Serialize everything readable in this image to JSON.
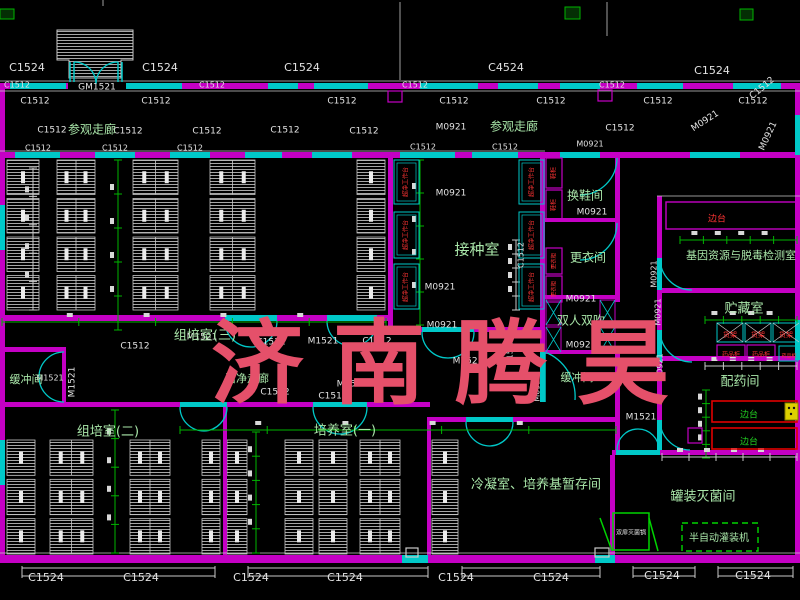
{
  "watermark": {
    "text": "济南腾昊",
    "color": "#e5506a"
  },
  "colors": {
    "wall": "#c400c4",
    "window": "#00c8c8",
    "dim_line": "#00b400",
    "white_line": "#c9c9c9",
    "code_text": "#e2e2e2",
    "room_text": "#a9e6a9",
    "equip_red": "#ff3434",
    "equip_green": "#22d022",
    "machine_green": "#00d400",
    "yellow": "#ddd000",
    "background": "#000000"
  },
  "labels": {
    "window_door_codes": [
      {
        "t": "C1524",
        "x": 27,
        "y": 68,
        "s": 11
      },
      {
        "t": "C1524",
        "x": 160,
        "y": 68,
        "s": 11
      },
      {
        "t": "C1524",
        "x": 302,
        "y": 68,
        "s": 11
      },
      {
        "t": "C4524",
        "x": 506,
        "y": 68,
        "s": 11
      },
      {
        "t": "C1524",
        "x": 712,
        "y": 71,
        "s": 11
      },
      {
        "t": "C1512",
        "x": 762,
        "y": 88,
        "s": 9,
        "r": -40
      },
      {
        "t": "GM1521",
        "x": 97,
        "y": 87,
        "s": 9
      },
      {
        "t": "C1512",
        "x": 17,
        "y": 85,
        "s": 8
      },
      {
        "t": "C1512",
        "x": 212,
        "y": 85,
        "s": 8
      },
      {
        "t": "C1512",
        "x": 415,
        "y": 85,
        "s": 8
      },
      {
        "t": "C1512",
        "x": 612,
        "y": 85,
        "s": 8
      },
      {
        "t": "C1512",
        "x": 35,
        "y": 101,
        "s": 9
      },
      {
        "t": "C1512",
        "x": 156,
        "y": 101,
        "s": 9
      },
      {
        "t": "C1512",
        "x": 342,
        "y": 101,
        "s": 9
      },
      {
        "t": "C1512",
        "x": 454,
        "y": 101,
        "s": 9
      },
      {
        "t": "C1512",
        "x": 551,
        "y": 101,
        "s": 9
      },
      {
        "t": "C1512",
        "x": 658,
        "y": 101,
        "s": 9
      },
      {
        "t": "C1512",
        "x": 753,
        "y": 101,
        "s": 9
      },
      {
        "t": "C1512",
        "x": 52,
        "y": 130,
        "s": 9
      },
      {
        "t": "C1512",
        "x": 128,
        "y": 131,
        "s": 9
      },
      {
        "t": "C1512",
        "x": 207,
        "y": 131,
        "s": 9
      },
      {
        "t": "C1512",
        "x": 285,
        "y": 130,
        "s": 9
      },
      {
        "t": "C1512",
        "x": 364,
        "y": 131,
        "s": 9
      },
      {
        "t": "M0921",
        "x": 451,
        "y": 127,
        "s": 9
      },
      {
        "t": "C1512",
        "x": 620,
        "y": 128,
        "s": 9
      },
      {
        "t": "M0921",
        "x": 705,
        "y": 121,
        "s": 9,
        "r": -33
      },
      {
        "t": "M0921",
        "x": 768,
        "y": 136,
        "s": 9,
        "r": -65
      },
      {
        "t": "C1512",
        "x": 38,
        "y": 148,
        "s": 8
      },
      {
        "t": "C1512",
        "x": 115,
        "y": 148,
        "s": 8
      },
      {
        "t": "C1512",
        "x": 190,
        "y": 148,
        "s": 8
      },
      {
        "t": "C1512",
        "x": 423,
        "y": 147,
        "s": 8
      },
      {
        "t": "C1512",
        "x": 505,
        "y": 147,
        "s": 8
      },
      {
        "t": "M0921",
        "x": 590,
        "y": 144,
        "s": 8
      },
      {
        "t": "M0921",
        "x": 451,
        "y": 193,
        "s": 9
      },
      {
        "t": "M0921",
        "x": 440,
        "y": 287,
        "s": 9
      },
      {
        "t": "M0921",
        "x": 442,
        "y": 325,
        "s": 9
      },
      {
        "t": "M0921",
        "x": 592,
        "y": 212,
        "s": 9
      },
      {
        "t": "M0921",
        "x": 581,
        "y": 299,
        "s": 9
      },
      {
        "t": "M0921",
        "x": 581,
        "y": 345,
        "s": 9
      },
      {
        "t": "C1512",
        "x": 521,
        "y": 255,
        "s": 8,
        "r": -90
      },
      {
        "t": "M1521",
        "x": 202,
        "y": 337,
        "s": 9
      },
      {
        "t": "C1512",
        "x": 271,
        "y": 342,
        "s": 9
      },
      {
        "t": "M1521",
        "x": 323,
        "y": 341,
        "s": 9
      },
      {
        "t": "C1512",
        "x": 377,
        "y": 341,
        "s": 9
      },
      {
        "t": "C1512",
        "x": 135,
        "y": 346,
        "s": 9
      },
      {
        "t": "M1521",
        "x": 72,
        "y": 382,
        "s": 9,
        "r": -90
      },
      {
        "t": "M1521",
        "x": 50,
        "y": 378,
        "s": 8
      },
      {
        "t": "M1521",
        "x": 352,
        "y": 384,
        "s": 9
      },
      {
        "t": "C1512",
        "x": 275,
        "y": 392,
        "s": 9
      },
      {
        "t": "C1512",
        "x": 333,
        "y": 396,
        "s": 9
      },
      {
        "t": "M1521",
        "x": 468,
        "y": 361,
        "s": 9
      },
      {
        "t": "C1512",
        "x": 510,
        "y": 352,
        "s": 8,
        "r": -90
      },
      {
        "t": "M0921",
        "x": 537,
        "y": 388,
        "s": 8,
        "r": -90
      },
      {
        "t": "M0921",
        "x": 660,
        "y": 367,
        "s": 8,
        "r": -90
      },
      {
        "t": "M1521",
        "x": 641,
        "y": 417,
        "s": 9
      },
      {
        "t": "M0921",
        "x": 654,
        "y": 274,
        "s": 8,
        "r": -90
      },
      {
        "t": "M0921",
        "x": 658,
        "y": 312,
        "s": 8,
        "r": -90
      },
      {
        "t": "C1524",
        "x": 46,
        "y": 578,
        "s": 11
      },
      {
        "t": "C1524",
        "x": 141,
        "y": 578,
        "s": 11
      },
      {
        "t": "C1524",
        "x": 251,
        "y": 578,
        "s": 11
      },
      {
        "t": "C1524",
        "x": 345,
        "y": 578,
        "s": 11
      },
      {
        "t": "C1524",
        "x": 456,
        "y": 578,
        "s": 11
      },
      {
        "t": "C1524",
        "x": 551,
        "y": 578,
        "s": 11
      },
      {
        "t": "C1524",
        "x": 662,
        "y": 576,
        "s": 11
      },
      {
        "t": "C1524",
        "x": 753,
        "y": 576,
        "s": 11
      }
    ],
    "room_names": [
      {
        "t": "参观走廊",
        "x": 92,
        "y": 130,
        "s": 12
      },
      {
        "t": "参观走廊",
        "x": 514,
        "y": 127,
        "s": 12
      },
      {
        "t": "组培室(三)",
        "x": 205,
        "y": 336,
        "s": 13
      },
      {
        "t": "接种室",
        "x": 477,
        "y": 250,
        "s": 15
      },
      {
        "t": "换鞋间",
        "x": 585,
        "y": 196,
        "s": 12
      },
      {
        "t": "更衣间",
        "x": 588,
        "y": 258,
        "s": 12
      },
      {
        "t": "双人双吹",
        "x": 581,
        "y": 321,
        "s": 12
      },
      {
        "t": "缓冲间",
        "x": 26,
        "y": 380,
        "s": 11
      },
      {
        "t": "缓冲间",
        "x": 577,
        "y": 378,
        "s": 11
      },
      {
        "t": "洁净走廊",
        "x": 247,
        "y": 379,
        "s": 11
      },
      {
        "t": "组培室(二)",
        "x": 108,
        "y": 432,
        "s": 13
      },
      {
        "t": "培养室(一)",
        "x": 345,
        "y": 431,
        "s": 13
      },
      {
        "t": "冷凝室、培养基暂存间",
        "x": 536,
        "y": 485,
        "s": 13
      },
      {
        "t": "罐装灭菌间",
        "x": 703,
        "y": 497,
        "s": 13
      },
      {
        "t": "基因资源与脱毒检测室",
        "x": 741,
        "y": 256,
        "s": 11
      },
      {
        "t": "贮藏室",
        "x": 744,
        "y": 309,
        "s": 13
      },
      {
        "t": "配药间",
        "x": 740,
        "y": 382,
        "s": 13
      },
      {
        "t": "半自动灌装机",
        "x": 719,
        "y": 538,
        "s": 10
      }
    ],
    "equipment_red": [
      {
        "t": "边台",
        "x": 717,
        "y": 219,
        "s": 9
      },
      {
        "t": "超净工作台",
        "x": 406,
        "y": 182,
        "s": 6,
        "r": -90
      },
      {
        "t": "超净工作台",
        "x": 406,
        "y": 235,
        "s": 6,
        "r": -90
      },
      {
        "t": "超净工作台",
        "x": 406,
        "y": 287,
        "s": 6,
        "r": -90
      },
      {
        "t": "超净工作台",
        "x": 532,
        "y": 182,
        "s": 6,
        "r": -90
      },
      {
        "t": "超净工作台",
        "x": 532,
        "y": 235,
        "s": 6,
        "r": -90
      },
      {
        "t": "超净工作台",
        "x": 532,
        "y": 287,
        "s": 6,
        "r": -90
      },
      {
        "t": "鞋柜",
        "x": 554,
        "y": 173,
        "s": 6,
        "r": -90
      },
      {
        "t": "鞋柜",
        "x": 554,
        "y": 205,
        "s": 6,
        "r": -90
      },
      {
        "t": "更衣柜",
        "x": 554,
        "y": 261,
        "s": 5.5,
        "r": -90
      },
      {
        "t": "更衣柜",
        "x": 554,
        "y": 289,
        "s": 5.5,
        "r": -90
      },
      {
        "t": "货架",
        "x": 730,
        "y": 335,
        "s": 7
      },
      {
        "t": "货架",
        "x": 758,
        "y": 335,
        "s": 7
      },
      {
        "t": "货架",
        "x": 786,
        "y": 335,
        "s": 7
      },
      {
        "t": "药品柜",
        "x": 731,
        "y": 355,
        "s": 6
      },
      {
        "t": "药品柜",
        "x": 761,
        "y": 355,
        "s": 6
      },
      {
        "t": "药品柜",
        "x": 789,
        "y": 356,
        "s": 5
      }
    ],
    "equipment_green": [
      {
        "t": "边台",
        "x": 749,
        "y": 415,
        "s": 9
      },
      {
        "t": "边台",
        "x": 749,
        "y": 442,
        "s": 9
      }
    ],
    "equipment_white": [
      {
        "t": "双扉灭菌锅",
        "x": 631,
        "y": 533,
        "s": 6
      }
    ]
  }
}
